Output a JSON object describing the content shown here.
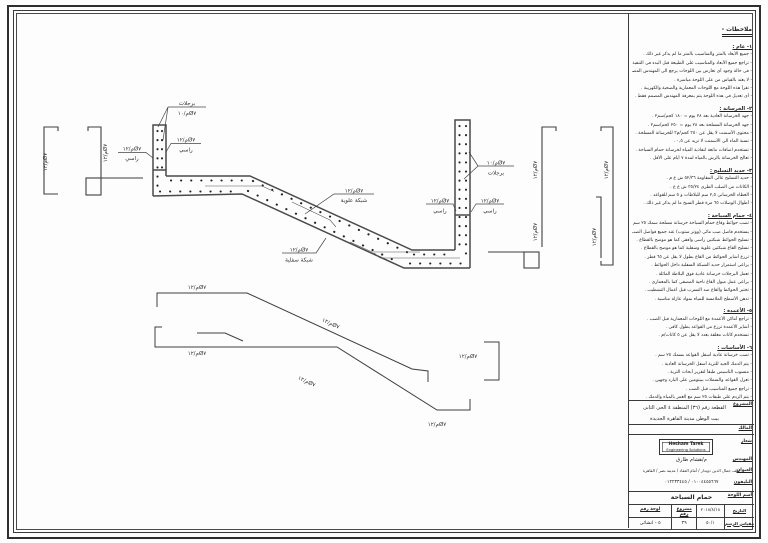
{
  "drawing": {
    "bar12": "م/١٢Ø٧",
    "bar10": "م/١٠Ø٧",
    "steps": "برجلات",
    "vertical": "راسي",
    "top_mesh": "شبكة علوية",
    "bottom_mesh": "شبكة سفلية"
  },
  "notes": {
    "title": "ملاحظات -",
    "rows": [
      {
        "cls": "nh",
        "text": "١- عام :"
      },
      {
        "cls": "nl",
        "text": "- جميع الأبعاد بالمتر والمناسيب بالمتر ما لم يذكر غير ذلك ."
      },
      {
        "cls": "nl",
        "text": "- تراجع جميع الأبعاد والمناسيب على الطبيعة قبل البدء فى التنفيذ ."
      },
      {
        "cls": "nl",
        "text": "- فى حالة وجود أى تعارض بين اللوحات يرجع الى المهندس المصمم ."
      },
      {
        "cls": "nl",
        "text": "- لا يعتد بالقياس من على اللوحة مباشرة ."
      },
      {
        "cls": "nl",
        "text": "- تقرأ هذه اللوحة مع اللوحات المعمارية والصحية والكهربية ."
      },
      {
        "cls": "nl",
        "text": "- أى تعديل فى هذه اللوحة يتم بمعرفة المهندس المصمم فقط ."
      },
      {
        "cls": "nh",
        "text": "٢- الخرسانة :"
      },
      {
        "cls": "nl",
        "text": "- جهد الخرسانة العادية بعد ٢٨ يوم = ١٨٠ كجم/سم٢ ."
      },
      {
        "cls": "nl",
        "text": "- جهد الخرسانة المسلحة بعد ٢٨ يوم = ٢٥٠ كجم/سم٢ ."
      },
      {
        "cls": "nl",
        "text": "- محتوى الأسمنت لا يقل عن ٣٥٠ كجم/م٣ للخرسانة المسلحة ."
      },
      {
        "cls": "nl",
        "text": "- نسبة الماء الى الأسمنت لا تزيد عن ٠,٥ ."
      },
      {
        "cls": "nl",
        "text": "- تستخدم اضافات مانعة لنفاذية المياه لخرسانة حمام السباحة ."
      },
      {
        "cls": "nl",
        "text": "- تعالج الخرسانة بالرش بالمياه لمدة ٧ أيام على الأقل ."
      },
      {
        "cls": "nh",
        "text": "٣- حديد التسليح :"
      },
      {
        "cls": "nl",
        "text": "- حديد التسليح عالى المقاومة ٥٢/٣٦ ش ع م ."
      },
      {
        "cls": "nl",
        "text": "- الكانات من الصلب الطرى ٣٥/٢٤ ش ع ع ."
      },
      {
        "cls": "nl",
        "text": "- الغطاء الخرسانى ٢,٥ سم للبلاطات و ٥ سم للقواعد ."
      },
      {
        "cls": "nl",
        "text": "- أطوال الوصلات ٦٥ مرة قطر السيخ ما لم يذكر غير ذلك ."
      },
      {
        "cls": "nh",
        "text": "٤- حمام السباحة :"
      },
      {
        "cls": "nl",
        "text": "- تصب حوائط وقاع حمام السباحة خرسانة مسلحة سمك ٢٥ سم ."
      },
      {
        "cls": "nl",
        "text": "- يستخدم فاصل صب مائى (ووتر ستوب) عند جميع فواصل الصب ."
      },
      {
        "cls": "nl",
        "text": "- تسليح الحوائط شبكتين رأسى وأفقى كما هو موضح بالقطاع ."
      },
      {
        "cls": "nl",
        "text": "- تسليح القاع شبكتين علوية وسفلية كما هو موضح بالقطاع ."
      },
      {
        "cls": "nl",
        "text": "- تزرع أشاير الحوائط من القاع بطول لا يقل عن ٦٥ قطر ."
      },
      {
        "cls": "nl",
        "text": "- يراعى استمرار حديد الشبكة السفلية داخل الحوائط ."
      },
      {
        "cls": "nl",
        "text": "- تعمل البرجلات خرسانة عادية فوق البلاطة المائلة ."
      },
      {
        "cls": "nl",
        "text": "- يراعى عمل ميول القاع ناحية المصفى كما بالمعمارى ."
      },
      {
        "cls": "nl",
        "text": "- تختبر الحوائط والقاع ضد التسرب قبل أعمال التشطيب ."
      },
      {
        "cls": "nl",
        "text": "- تدهن الأسطح الملامسة للمياه بمواد عازلة مناسبة ."
      },
      {
        "cls": "nh",
        "text": "٥- الأعمدة :"
      },
      {
        "cls": "nl",
        "text": "- تراجع أماكن الأعمدة مع اللوحات المعمارية قبل الصب ."
      },
      {
        "cls": "nl",
        "text": "- أشاير الأعمدة تزرع من القواعد بطول كافى ."
      },
      {
        "cls": "nl",
        "text": "- تستخدم كانات مغلقة بعدد لا يقل عن ٥ كانات/م ."
      },
      {
        "cls": "nh",
        "text": "٦- الأساسات :"
      },
      {
        "cls": "nl",
        "text": "- تصب خرسانة عادية أسفل القواعد بسمك ٢٥ سم ."
      },
      {
        "cls": "nl",
        "text": "- يتم الدمك الجيد للتربة أسفل الخرسانة العادية ."
      },
      {
        "cls": "nl",
        "text": "- منسوب التأسيس طبقاً لتقرير أبحاث التربة ."
      },
      {
        "cls": "nl",
        "text": "- تعزل القواعد والسملات ببيتومين على البارد وجهين ."
      },
      {
        "cls": "nl",
        "text": "- تراجع جميع المناسيب قبل الصب ."
      },
      {
        "cls": "nl",
        "text": "- يتم الردم على طبقات ٢٥ سم مع الغمر بالمياه والدمك ."
      }
    ]
  },
  "title_block": {
    "project_label": "المشروع",
    "project_line1": "القطعة رقم (٣٦) المنطقة ٤ الحى الثانى",
    "project_line2": "بيت الوطن مدينة القاهرة الجديدة",
    "owner_label": "المالك",
    "logo_label": "شعار",
    "logo_line1": "Hesham Tarek",
    "logo_line2": "Engineering Solutions",
    "engineer_label": "المهندس",
    "engineer_name": "م/هشام طارق",
    "address_label": "العنوان",
    "address": "خلف جمال الدين دويدار / أمام العقاد / مدينة نصر / القاهرة",
    "phone_label": "التليفون",
    "phone": "٠١٠٠٤٤٥٥٦٦٧ / ٠١٢٢٣٣٤٤٥",
    "sheet_name_label": "أسم اللوحة",
    "sheet_name": "حمام السباحة",
    "date_label": "التاريخ",
    "date_value": "٢٠١٨/٨/١٨",
    "scale_label": "مقياس الرسم",
    "scale_value": "٥٠/١",
    "project_no_label": "مشروع رقم",
    "project_no": "٣٩",
    "sheet_no_label": "لوحة رقم",
    "sheet_no": "٥ - انشائى"
  }
}
